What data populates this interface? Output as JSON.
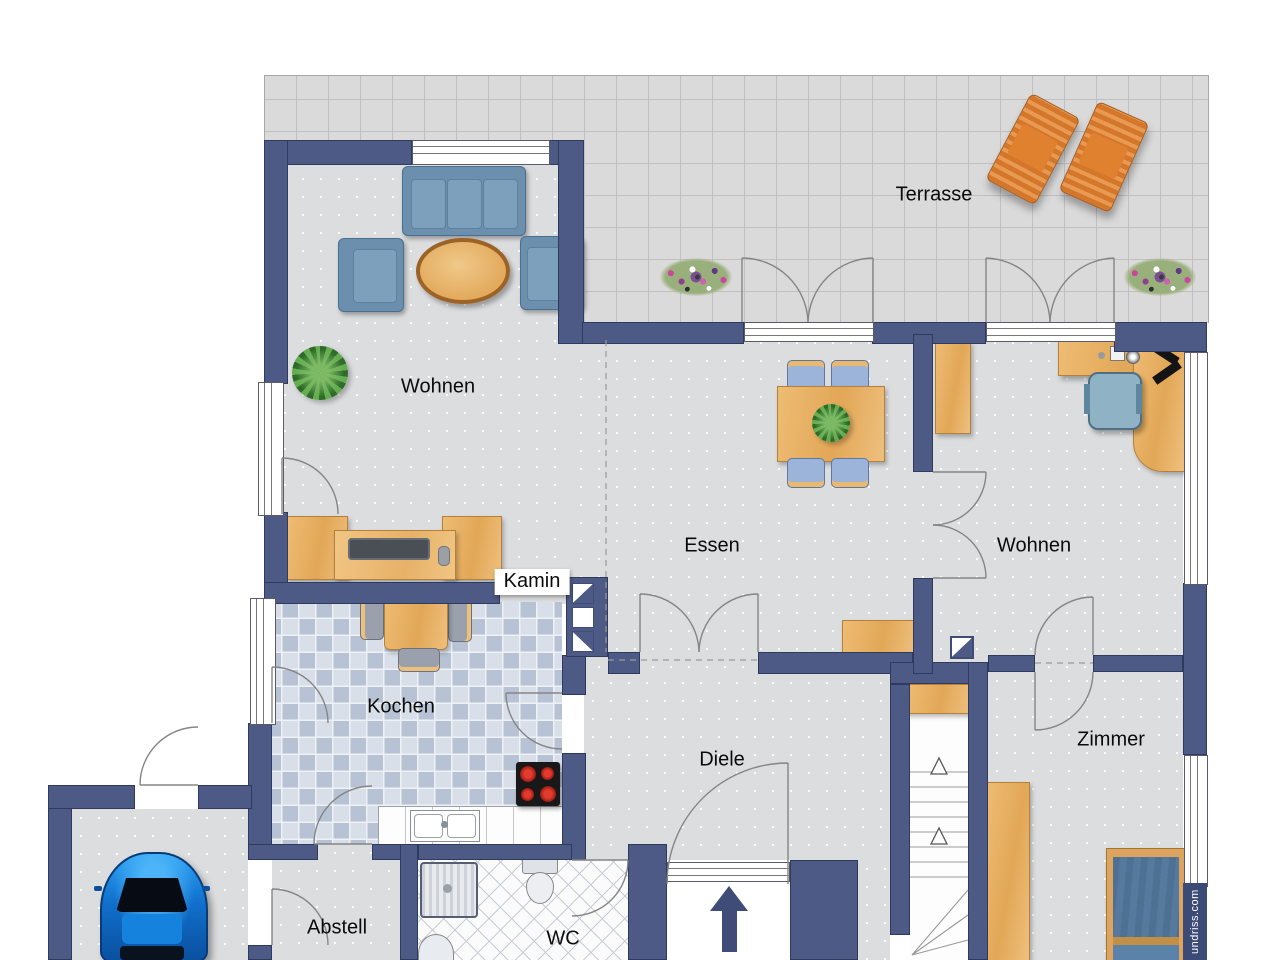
{
  "plan": {
    "title_none": "",
    "labels": {
      "terrasse": "Terrasse",
      "wohnen_left": "Wohnen",
      "essen": "Essen",
      "wohnen_right": "Wohnen",
      "kamin": "Kamin",
      "kochen": "Kochen",
      "diele": "Diele",
      "zimmer": "Zimmer",
      "abstell": "Abstell",
      "wc": "WC"
    },
    "watermark": "undriss.com",
    "colors": {
      "wall": "#4d5a85",
      "floor": "#dcdddf",
      "terrace_tile": "#dadada",
      "kitchen_tile": "#b7c3d4",
      "wood": "#e2a757",
      "sofa_blue": "#6b8fac",
      "bed_blue": "#4d7093",
      "car_blue": "#1170cc",
      "lounger_orange": "#e0812f",
      "watermark_bg": "#3c4a76"
    },
    "symbols": {
      "entrance_arrow": "up",
      "stair_direction": "up",
      "furniture": [
        "sofa",
        "armchair",
        "coffee-table",
        "plant",
        "tv-sideboard",
        "dining-table",
        "dining-chair",
        "sideboard",
        "desk",
        "office-chair",
        "cabinet",
        "wardrobe",
        "kitchen-table",
        "kitchen-chair",
        "stove",
        "sink",
        "counter",
        "shower",
        "toilet",
        "washbasin",
        "bed",
        "car",
        "sun-lounger",
        "flower-box",
        "fireplace",
        "staircase"
      ]
    }
  }
}
